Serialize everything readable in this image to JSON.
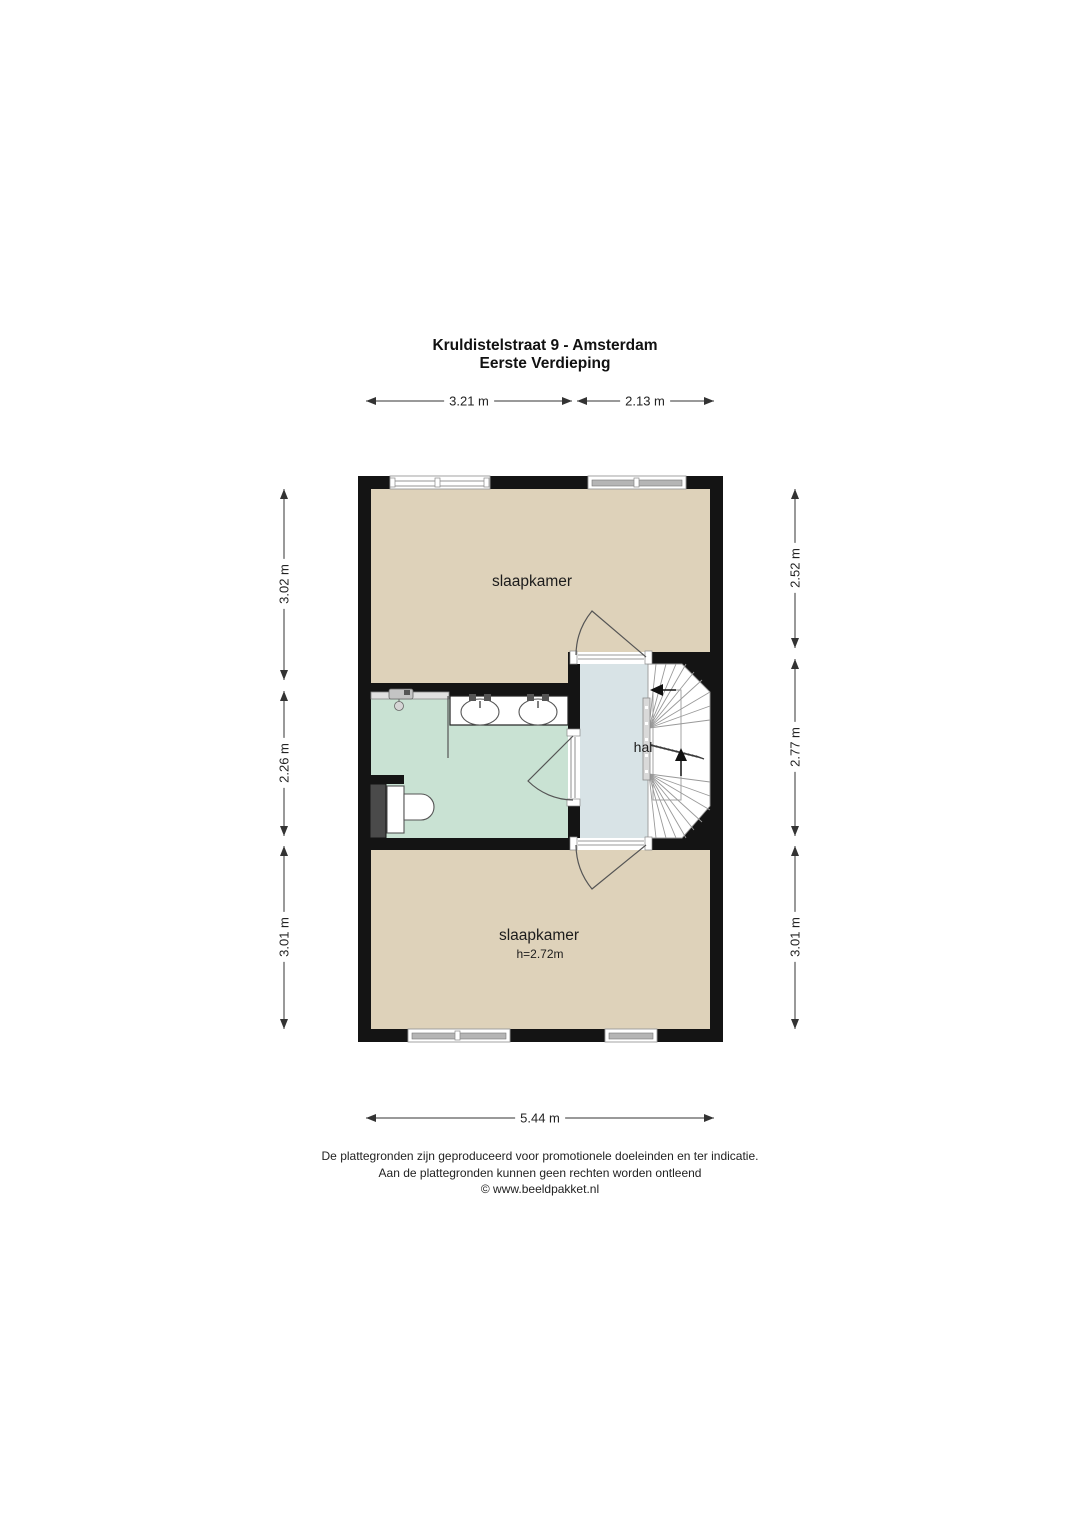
{
  "page": {
    "title": "Kruldistelstraat 9 - Amsterdam",
    "subtitle": "Eerste Verdieping"
  },
  "floor_plan": {
    "rooms": {
      "bedroom_top": {
        "label": "slaapkamer"
      },
      "bedroom_bottom": {
        "label": "slaapkamer",
        "ceiling_height": "h=2.72m"
      },
      "hall": {
        "label": "hal"
      }
    },
    "dimensions": {
      "top": [
        "3.21 m",
        "2.13 m"
      ],
      "bottom": [
        "5.44 m"
      ],
      "left": [
        "3.02 m",
        "2.26 m",
        "3.01 m"
      ],
      "right": [
        "2.52 m",
        "2.77 m",
        "3.01 m"
      ]
    }
  },
  "footer": {
    "line1": "De plattegronden zijn geproduceerd voor promotionele doeleinden en ter indicatie.",
    "line2": "Aan de plattegronden kunnen geen rechten worden ontleend",
    "line3": "© www.beeldpakket.nl"
  },
  "colors": {
    "wall": "#141414",
    "floor_beige": "#ded2ba",
    "bathroom_green": "#c9e2d3",
    "hall_blue": "#d8e3e6",
    "duct_gray": "#4a4a4a",
    "dimension": "#333333"
  }
}
